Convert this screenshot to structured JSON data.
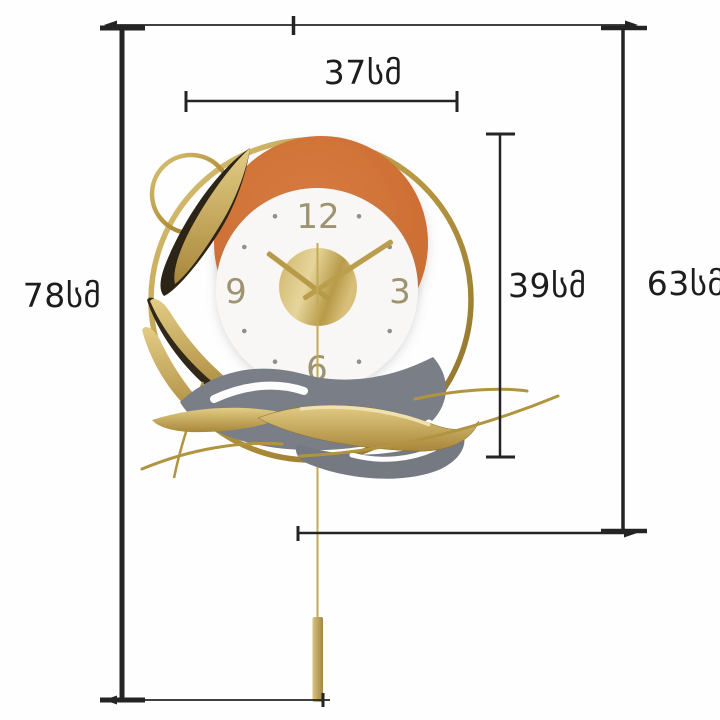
{
  "background": "#fefefe",
  "dimension_labels": {
    "width_top": "37სმ",
    "inner_height": "39სმ",
    "total_height": "78სმ",
    "body_height": "63სმ"
  },
  "clock": {
    "numerals": {
      "twelve": "12",
      "three": "3",
      "six": "6",
      "nine": "9"
    },
    "time_depicted": "10:10",
    "colors": {
      "gold": "#b5963f",
      "gold_light": "#ddc276",
      "orange": "#d07135",
      "face_white": "#f8f7f5",
      "leaf_gray": "#7a7f87",
      "dimension_line": "#242424",
      "numeral_color": "#9d9371"
    }
  }
}
